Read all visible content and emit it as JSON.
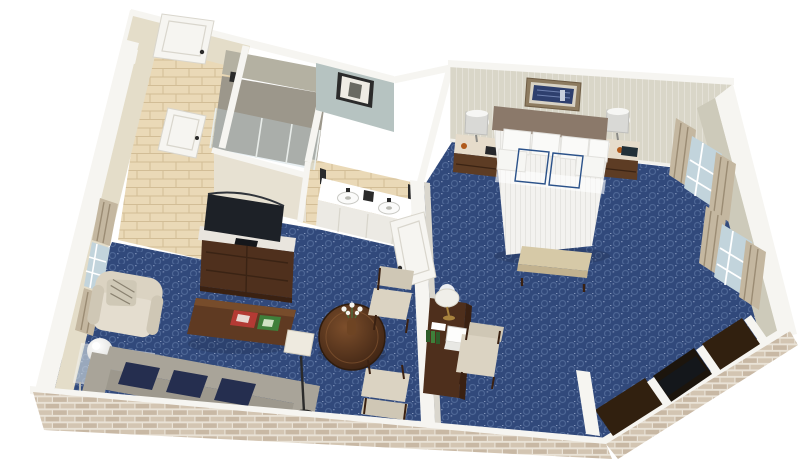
{
  "scene": {
    "description": "3D isometric cutaway floor plan render of a hotel suite, viewed from above",
    "rooms": [
      {
        "name": "entry-hall",
        "floor": "tan-tile",
        "features": [
          "entry-door-open",
          "closet-door"
        ]
      },
      {
        "name": "shower-room",
        "floor": "grey-stone",
        "features": [
          "glass-enclosure",
          "shower-head"
        ]
      },
      {
        "name": "bathroom-vanity",
        "floor": "tan-tile",
        "features": [
          "double-sink-counter",
          "wall-sconces",
          "framed-art-wall"
        ]
      },
      {
        "name": "living-room",
        "floor": "blue-patterned-carpet",
        "furniture": [
          "tv-armoire-with-flat-screen",
          "coffee-table-with-magazines",
          "grey-sofa",
          "navy-throw-pillows",
          "cream-armchair-with-accent-pillow",
          "glass-side-table-with-globe-lamp",
          "round-dining-table-with-flowers",
          "two-dining-chairs",
          "floor-lamp"
        ],
        "windows": 1
      },
      {
        "name": "bedroom",
        "floor": "blue-patterned-carpet",
        "furniture": [
          "king-bed-white-linens",
          "brown-headboard",
          "framed-art-above-bed",
          "two-nightstands",
          "two-table-lamps",
          "telephone",
          "foot-bench",
          "writing-desk",
          "desk-lamp",
          "laptop",
          "desk-chair",
          "closet-niches",
          "luggage-bench"
        ],
        "windows": 2
      }
    ],
    "counts": {
      "sofa_navy_pillows": 3,
      "bed_white_pillows": 6,
      "bed_blue_accent_pillows": 2,
      "vanity_sinks": 2,
      "windows_left_wall": 1,
      "windows_right_wall": 2,
      "nightstands": 2,
      "dining_chairs": 2
    },
    "exterior": "tan brick veneer on front walls, white wall caps"
  },
  "colors": {
    "bg": "#ffffff",
    "wallCap": "#f6f5f1",
    "wallEdge": "#d9d6cd",
    "wallCream": "#e7e1d2",
    "wallEntry": "#e4ddc9",
    "accentWall": "#b6c3c1",
    "bedroomWall": "#d9d6c8",
    "rightWall": "#cdcaba",
    "carpet": "#31497b",
    "carpetRing": "#4d6695",
    "carpetFleck": "#8295bb",
    "tile": "#ead9b7",
    "tileLine": "#d2bd96",
    "stoneFloor": "#9c978b",
    "stoneWall": "#b4b1a2",
    "glass": "#c2d4dc",
    "curtain": "#c4b7a0",
    "curtainStripe": "#9b8c74",
    "brickBg": "#e9e2d6",
    "brickA": "#d3c5b2",
    "brickB": "#c8b8a4",
    "woodDark": "#4f301d",
    "woodMid": "#5f3a22",
    "woodDeep": "#3a2112",
    "woodLight": "#7c4e2b",
    "marble": "#e9e5de",
    "tv": "#1d2127",
    "sofa": "#9d988d",
    "sofaBack": "#a9a499",
    "navy": "#252e4f",
    "cream": "#dbd3c2",
    "creamDark": "#cfc7b5",
    "bedWhite": "#f3f2ef",
    "bedStripe": "#e5e4e0",
    "headboard": "#8b796a",
    "pillowBlue": "#3c6dac",
    "pillowBlueDark": "#2b528a",
    "benchTan": "#d6c9a7",
    "lampSilver": "#d9d9d6",
    "closetDark": "#31200f",
    "closetDark2": "#1c150d",
    "luggage": "#14171b",
    "artNavy": "#2e3f6e",
    "frameTan": "#8d7b60",
    "green": "#3f7f3a",
    "red": "#b43a34",
    "gold": "#a8833e",
    "metal": "#2b2b2b"
  }
}
